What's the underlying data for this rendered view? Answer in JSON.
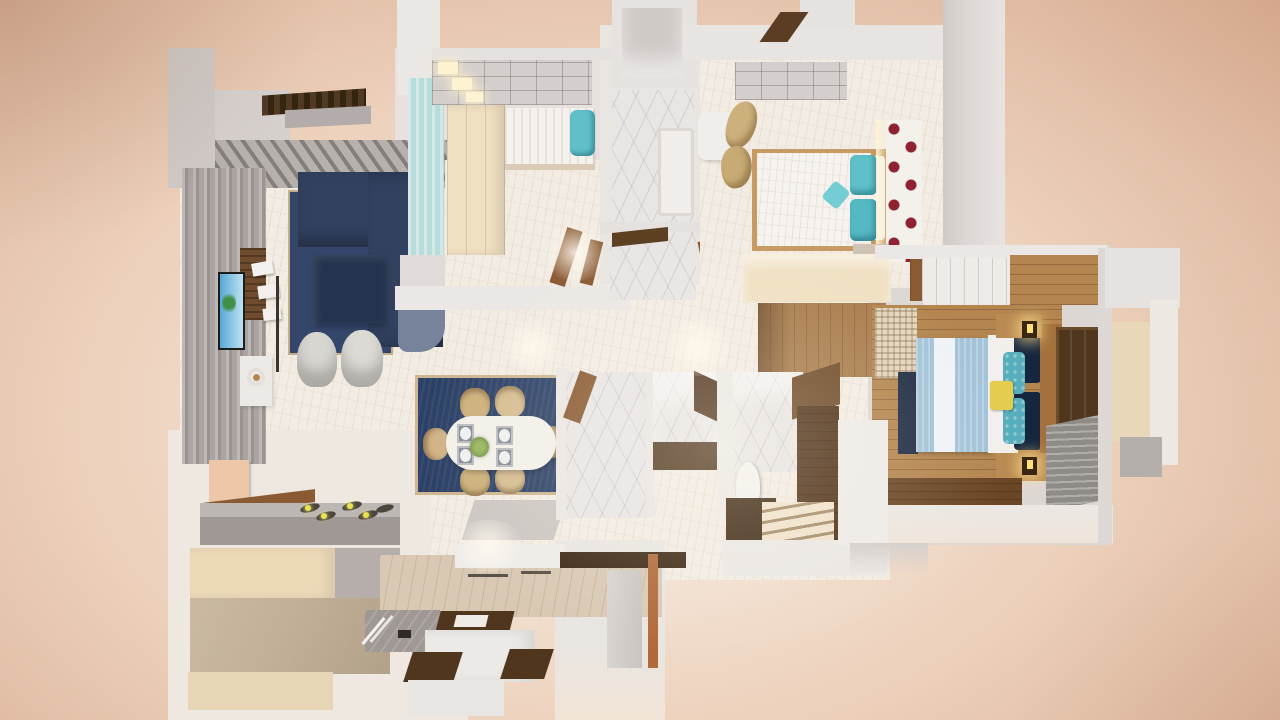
{
  "scene": {
    "title": "3D apartment floor plan render",
    "view": "top-down dollhouse perspective",
    "style": "photorealistic architectural visualization",
    "visible_text": "none"
  },
  "palette": {
    "peach_deep": "#d7ab92",
    "peach_mid": "#ecd0ba",
    "peach_light": "#f8efe7",
    "wall_white": "#ebe7e4",
    "wall_light": "#e0dbd8",
    "wall_gray": "#cfc9c6",
    "wall_dark": "#b3acaa",
    "floor_cream": "#f3ece3",
    "marble": "#e8e5e4",
    "gray_panel": "#aba4a1",
    "navy_sofa": "#31415f",
    "navy_dark": "#24344f",
    "navy_rug": "#2c4166",
    "navy_pillow": "#16263f",
    "teal": "#5fc0ca",
    "aqua_wall": "#b8dcd9",
    "cream_wardrobe": "#f0e0c2",
    "tan_chair": "#cdb17c",
    "tan_counter": "#c2b098",
    "wood_mid": "#b4854f",
    "wood_warm": "#a97c4c",
    "walnut": "#4f361d",
    "walnut_deep": "#3a2713",
    "door_brown": "#8a5a33",
    "orange_pole": "#b06a3a",
    "blue_duvet": "#a3c3d9",
    "yellow_pillow": "#e3cc4e",
    "red_dot": "#8e2230",
    "lamp_glow": "#ffe27a",
    "light_warm": "#fdf2d2",
    "gray_rug": "#8f8b86",
    "steel": "#9f9894",
    "step_cream": "#f0e2cc",
    "white_soft": "#f2efec",
    "tv_frame": "#1c1c1c",
    "tv_sky": "#57a8d8",
    "tv_tree": "#3f8f46"
  },
  "rooms": [
    {
      "name": "balcony",
      "furniture": [
        "planter-hedge",
        "louver-deck"
      ]
    },
    {
      "name": "living-room",
      "furniture": [
        "l-shaped-navy-sofa",
        "navy-ottoman",
        "navy-area-rug",
        "wall-tv",
        "media-panel",
        "floating-shelves",
        "floor-lamp",
        "side-table-with-bowl",
        "two-accent-chairs",
        "striped-panel-wall"
      ]
    },
    {
      "name": "dining-area",
      "furniture": [
        "oval-white-table",
        "six-cream-chairs",
        "navy-rug-tan-border",
        "placemats-with-plates",
        "green-centerpiece"
      ]
    },
    {
      "name": "kitchen",
      "furniture": [
        "gas-hob-five-burners",
        "leaning-board",
        "gray-counter",
        "cream-cabinets",
        "tan-counter-slab",
        "sink-with-faucet",
        "island-walnut-tops",
        "two-walnut-stools"
      ]
    },
    {
      "name": "bedroom-single",
      "furniture": [
        "single-bed",
        "teal-pillow",
        "cream-wardrobe",
        "aqua-accent-wall",
        "ceiling-grid",
        "recessed-lights",
        "wood-door"
      ]
    },
    {
      "name": "bedroom-double",
      "furniture": [
        "double-bed-white-duvet",
        "teal-pillows",
        "tan-lounge-chairs",
        "white-desk",
        "polka-dot-accent-wall",
        "cream-wardrobe",
        "ceiling-grid"
      ]
    },
    {
      "name": "master-bedroom",
      "furniture": [
        "double-bed-blue-striped-duvet",
        "navy-pillows",
        "teal-textured-pillows",
        "yellow-pillow",
        "wood-headboard",
        "two-bedside-lamps",
        "nightstands",
        "walnut-wardrobe",
        "woven-sliding-door",
        "navy-bench",
        "gray-striped-rug",
        "wood-plank-floor"
      ]
    },
    {
      "name": "bathroom-marble",
      "furniture": [
        "marble-floor",
        "shower-tray",
        "wood-door-ajar"
      ]
    },
    {
      "name": "toilet-room",
      "furniture": [
        "marble-floor",
        "walnut-vanity",
        "walnut-cabinet"
      ]
    },
    {
      "name": "bathroom-stairs",
      "furniture": [
        "marble-walls",
        "toilet",
        "walnut-counter",
        "cream-steps",
        "walnut-side-walls"
      ]
    },
    {
      "name": "hallway",
      "furniture": [
        "wood-floor",
        "cream-floor",
        "ceiling-light-pools",
        "wood-chairs"
      ]
    },
    {
      "name": "entry",
      "furniture": [
        "walnut-shelf-bar",
        "orange-door-frame",
        "light-gray-floor"
      ]
    }
  ]
}
